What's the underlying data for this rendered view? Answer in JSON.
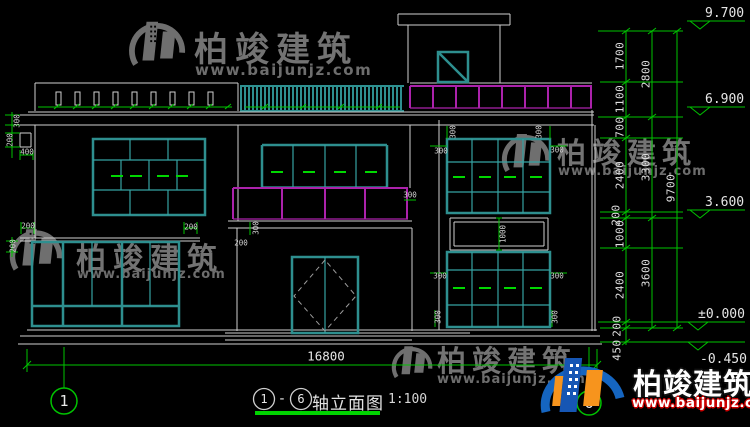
{
  "drawing": {
    "title": {
      "axis_start": "1",
      "separator": "-",
      "axis_end": "6",
      "name": "轴立面图",
      "scale": "1:100"
    },
    "overall_width_dim": "16800",
    "axis_bubbles": {
      "left": "1",
      "right": "6"
    },
    "levels": [
      "9.700",
      "6.900",
      "3.600",
      "±0.000",
      "-0.450"
    ],
    "right_dims": {
      "inner": [
        "1700",
        "1100",
        "700",
        "2400",
        "200",
        "1000",
        "2400",
        "200",
        "450"
      ],
      "middle": [
        "2800",
        "3300",
        "3600"
      ],
      "overall": "9700"
    },
    "tiny_dims": [
      "300",
      "200",
      "400",
      "200",
      "200",
      "200",
      "300",
      "200",
      "300",
      "300",
      "300",
      "300",
      "300",
      "1000",
      "300",
      "300",
      "300",
      "300"
    ],
    "colors": {
      "background": "#000000",
      "lines_white": "#cfcfcf",
      "frame_teal": "#2e8f8f",
      "grid_teal": "#35a2a2",
      "railing_magenta": "#ab22ab",
      "dimension_green": "#00c300",
      "dash_green": "#00d800"
    }
  },
  "watermark": {
    "brand": "柏竣建筑",
    "url": "www.baijunjz.com"
  },
  "footer_logo": {
    "brand": "柏竣建筑",
    "url": "www.baijunjz.com"
  }
}
